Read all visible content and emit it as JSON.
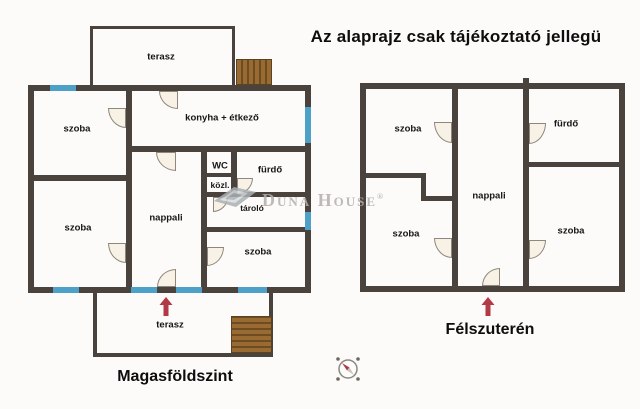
{
  "title": "Az alaprajz csak tájékoztató jellegü",
  "watermark": {
    "text": "Duna House",
    "reg": "®"
  },
  "floors": [
    {
      "name": "Magasföldszint",
      "rooms": [
        "terasz",
        "szoba",
        "konyha + étkező",
        "WC",
        "közl.",
        "fürdő",
        "tároló",
        "nappali",
        "szoba",
        "szoba",
        "terasz"
      ]
    },
    {
      "name": "Félszuterén",
      "rooms": [
        "szoba",
        "fürdő",
        "nappali",
        "szoba",
        "szoba"
      ]
    }
  ],
  "icons": {
    "entrance_arrow": "up-arrow",
    "compass": "compass-rose"
  },
  "colors": {
    "wall": "#4a423c",
    "window": "#4da0c8",
    "door_fill": "#f7f1e6",
    "stairs": "#9a6a33",
    "arrow": "#b23a47",
    "watermark": "#b3afab"
  }
}
